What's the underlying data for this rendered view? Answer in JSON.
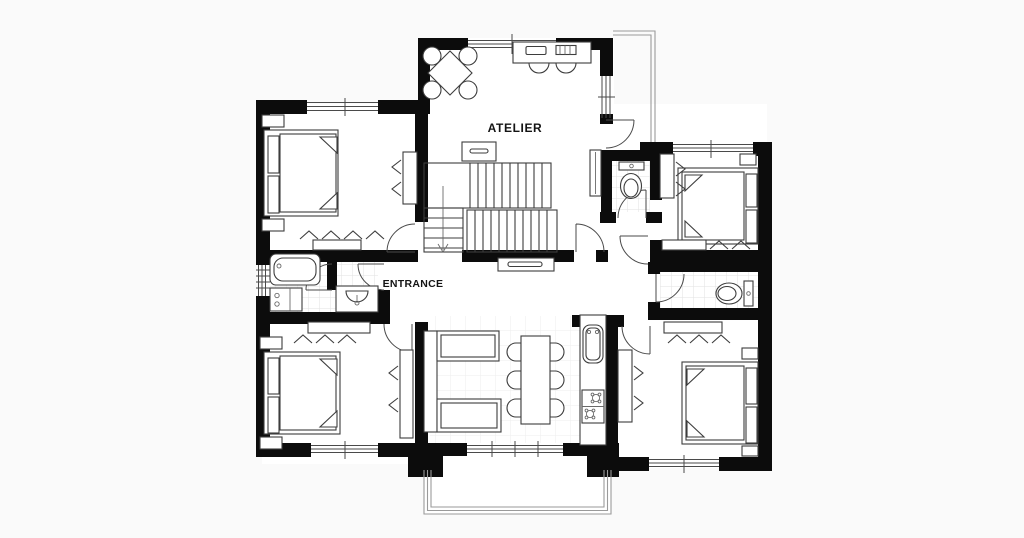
{
  "canvas": {
    "width": 1024,
    "height": 538
  },
  "colors": {
    "background": "#fafafa",
    "floor": "#ffffff",
    "wall": "#0c0c0c",
    "furniture_line": "#3d3d3d",
    "tile": "#e2e2e2",
    "railing": "#9a9a9a",
    "text": "#141414"
  },
  "labels": {
    "atelier": "ATELIER",
    "entrance": "ENTRANCE"
  },
  "rooms": [
    {
      "id": "atelier",
      "label": "ATELIER",
      "furniture": [
        "square meeting table",
        "4 round chairs",
        "wall desk",
        "2 desk chairs",
        "storage cabinet",
        "staircase"
      ]
    },
    {
      "id": "entrance-hall",
      "label": "ENTRANCE",
      "furniture": [
        "console table"
      ]
    },
    {
      "id": "bedroom-top-left",
      "furniture": [
        "double bed",
        "2 nightstands",
        "wardrobe",
        "dresser"
      ]
    },
    {
      "id": "bathroom",
      "furniture": [
        "bathtub",
        "washbasin",
        "cabinet"
      ]
    },
    {
      "id": "wc-top",
      "furniture": [
        "toilet"
      ]
    },
    {
      "id": "bedroom-top-right",
      "furniture": [
        "double bed",
        "nightstand",
        "wardrobe",
        "dresser"
      ]
    },
    {
      "id": "wc-right",
      "furniture": [
        "toilet"
      ]
    },
    {
      "id": "living-dining",
      "furniture": [
        "corner sofa",
        "dining table",
        "6 dining chairs",
        "kitchen counter",
        "sink",
        "stove"
      ]
    },
    {
      "id": "bedroom-bottom-left",
      "furniture": [
        "double bed",
        "2 nightstands",
        "wardrobe",
        "dresser"
      ]
    },
    {
      "id": "bedroom-bottom-right",
      "furniture": [
        "double bed",
        "2 nightstands",
        "wardrobe",
        "dresser"
      ]
    },
    {
      "id": "balcony",
      "furniture": [
        "railing"
      ]
    },
    {
      "id": "terrace",
      "furniture": [
        "railing"
      ]
    }
  ]
}
